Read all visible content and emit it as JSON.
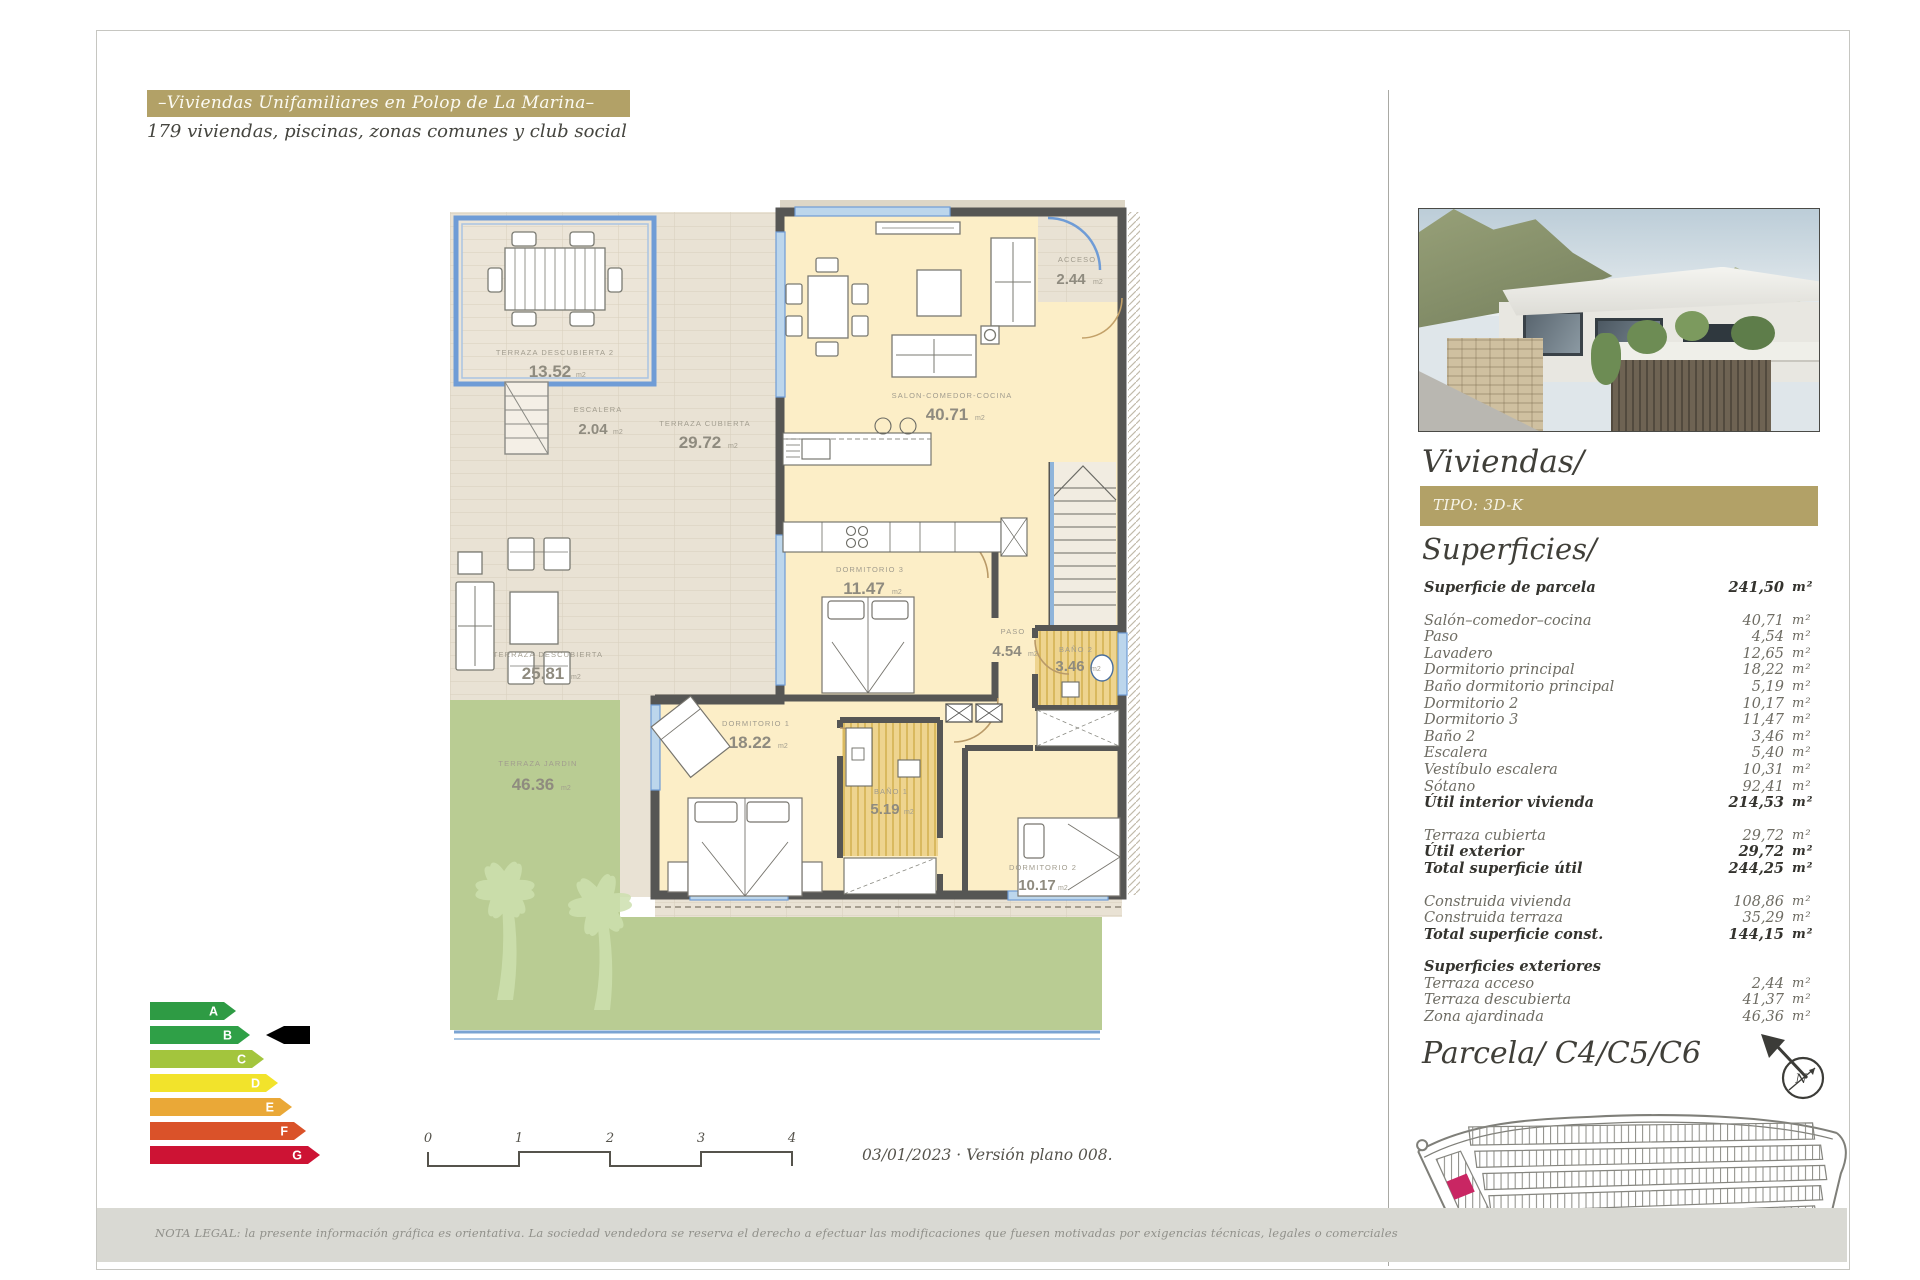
{
  "header": {
    "title": "–Viviendas Unifamiliares en Polop de La Marina–",
    "subtitle": "179 viviendas, piscinas, zonas comunes y club social"
  },
  "plan": {
    "rooms": [
      {
        "name": "TERRAZA DESCUBIERTA 2",
        "area": "13.52",
        "unit": "m2"
      },
      {
        "name": "ESCALERA",
        "area": "2.04",
        "unit": "m2"
      },
      {
        "name": "TERRAZA CUBIERTA",
        "area": "29.72",
        "unit": "m2"
      },
      {
        "name": "ACCESO",
        "area": "2.44",
        "unit": "m2"
      },
      {
        "name": "SALON-COMEDOR-COCINA",
        "area": "40.71",
        "unit": "m2"
      },
      {
        "name": "DORMITORIO 3",
        "area": "11.47",
        "unit": "m2"
      },
      {
        "name": "PASO",
        "area": "4.54",
        "unit": "m2"
      },
      {
        "name": "BAÑO 2",
        "area": "3.46",
        "unit": "m2"
      },
      {
        "name": "TERRAZA DESCUBIERTA",
        "area": "25.81",
        "unit": "m2"
      },
      {
        "name": "DORMITORIO 1",
        "area": "18.22",
        "unit": "m2"
      },
      {
        "name": "BAÑO 1",
        "area": "5.19",
        "unit": "m2"
      },
      {
        "name": "DORMITORIO 2",
        "area": "10.17",
        "unit": "m2"
      },
      {
        "name": "TERRAZA JARDIN",
        "area": "46.36",
        "unit": "m2"
      }
    ]
  },
  "sidebar": {
    "title": "Viviendas/",
    "tipo": "TIPO: 3D-K",
    "superficies_title": "Superficies/",
    "parcela_title": "Parcela/ C4/C5/C6",
    "compass_n": "N",
    "rows": [
      {
        "label": "Superficie de parcela",
        "value": "241,50",
        "unit": "m²"
      },
      {
        "label": "Salón–comedor–cocina",
        "value": "40,71",
        "unit": "m²"
      },
      {
        "label": "Paso",
        "value": "4,54",
        "unit": "m²"
      },
      {
        "label": "Lavadero",
        "value": "12,65",
        "unit": "m²"
      },
      {
        "label": "Dormitorio principal",
        "value": "18,22",
        "unit": "m²"
      },
      {
        "label": "Baño dormitorio principal",
        "value": "5,19",
        "unit": "m²"
      },
      {
        "label": "Dormitorio 2",
        "value": "10,17",
        "unit": "m²"
      },
      {
        "label": "Dormitorio 3",
        "value": "11,47",
        "unit": "m²"
      },
      {
        "label": "Baño 2",
        "value": "3,46",
        "unit": "m²"
      },
      {
        "label": "Escalera",
        "value": "5,40",
        "unit": "m²"
      },
      {
        "label": "Vestíbulo escalera",
        "value": "10,31",
        "unit": "m²"
      },
      {
        "label": "Sótano",
        "value": "92,41",
        "unit": "m²"
      },
      {
        "label": "Útil interior vivienda",
        "value": "214,53",
        "unit": "m²"
      },
      {
        "label": "Terraza cubierta",
        "value": "29,72",
        "unit": "m²"
      },
      {
        "label": "Útil exterior",
        "value": "29,72",
        "unit": "m²"
      },
      {
        "label": "Total superficie útil",
        "value": "244,25",
        "unit": "m²"
      },
      {
        "label": "Construida vivienda",
        "value": "108,86",
        "unit": "m²"
      },
      {
        "label": "Construida terraza",
        "value": "35,29",
        "unit": "m²"
      },
      {
        "label": "Total superficie const.",
        "value": "144,15",
        "unit": "m²"
      },
      {
        "label": "Superficies exteriores",
        "value": "",
        "unit": ""
      },
      {
        "label": "Terraza acceso",
        "value": "2,44",
        "unit": "m²"
      },
      {
        "label": "Terraza descubierta",
        "value": "41,37",
        "unit": "m²"
      },
      {
        "label": "Zona ajardinada",
        "value": "46,36",
        "unit": "m²"
      }
    ]
  },
  "energy": {
    "rating": "B",
    "levels": [
      {
        "letter": "A",
        "color": "#2e9b44"
      },
      {
        "letter": "B",
        "color": "#2fa047"
      },
      {
        "letter": "C",
        "color": "#a3c53d"
      },
      {
        "letter": "D",
        "color": "#f2e32b"
      },
      {
        "letter": "E",
        "color": "#eaa837"
      },
      {
        "letter": "F",
        "color": "#da5229"
      },
      {
        "letter": "G",
        "color": "#cd1334"
      }
    ]
  },
  "footer": {
    "scale_ticks": [
      "0",
      "1",
      "2",
      "3",
      "4"
    ],
    "version": "03/01/2023 · Versión plano 008.",
    "legal": "NOTA LEGAL: la presente información gráfica es orientativa. La sociedad vendedora se reserva el derecho a efectuar las modificaciones que fuesen motivadas por exigencias técnicas, legales o comerciales"
  }
}
